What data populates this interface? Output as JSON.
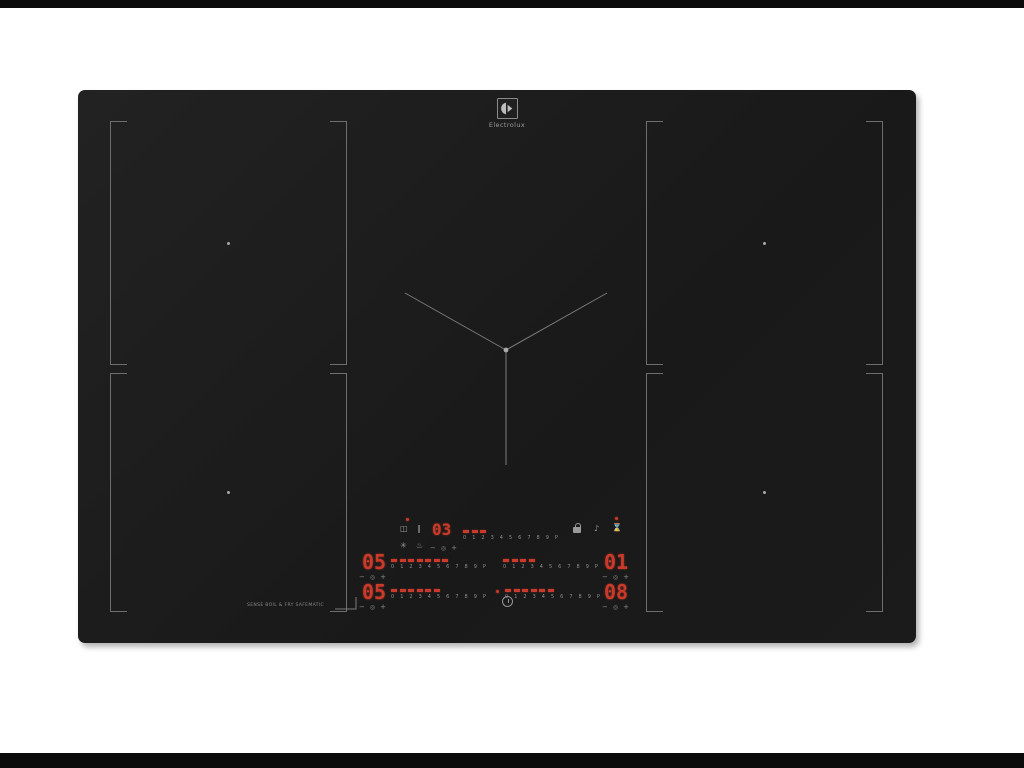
{
  "colors": {
    "led": "#c93a2a",
    "mark": "#6e6e6e",
    "dim": "#9a9a9a",
    "body": "#1d1d1d"
  },
  "brand": {
    "logo_text": "Electrolux"
  },
  "hob": {
    "feature_label": "SENSE BOIL & FRY SAFEMATIC",
    "scale_labels": [
      "0",
      "1",
      "2",
      "3",
      "4",
      "5",
      "6",
      "7",
      "8",
      "9",
      "P"
    ],
    "displays": {
      "timer": "03",
      "row1_left": "05",
      "row1_right": "01",
      "row2_left": "05",
      "row2_right": "08"
    },
    "sliders": [
      {
        "id": "timer-strip",
        "lit": 3
      },
      {
        "id": "row1-left-strip",
        "lit": 7
      },
      {
        "id": "row1-right-strip",
        "lit": 4
      },
      {
        "id": "row2-left-strip",
        "lit": 6
      },
      {
        "id": "row2-right-strip",
        "lit": 6
      }
    ],
    "controls": {
      "minus": "−",
      "select": "◎",
      "plus": "+"
    },
    "icons": {
      "bridge": "◫",
      "pause": "∥",
      "hob2hood": "✳",
      "sense_fry": "♨",
      "sound": "♪",
      "timer": "⌛"
    }
  }
}
